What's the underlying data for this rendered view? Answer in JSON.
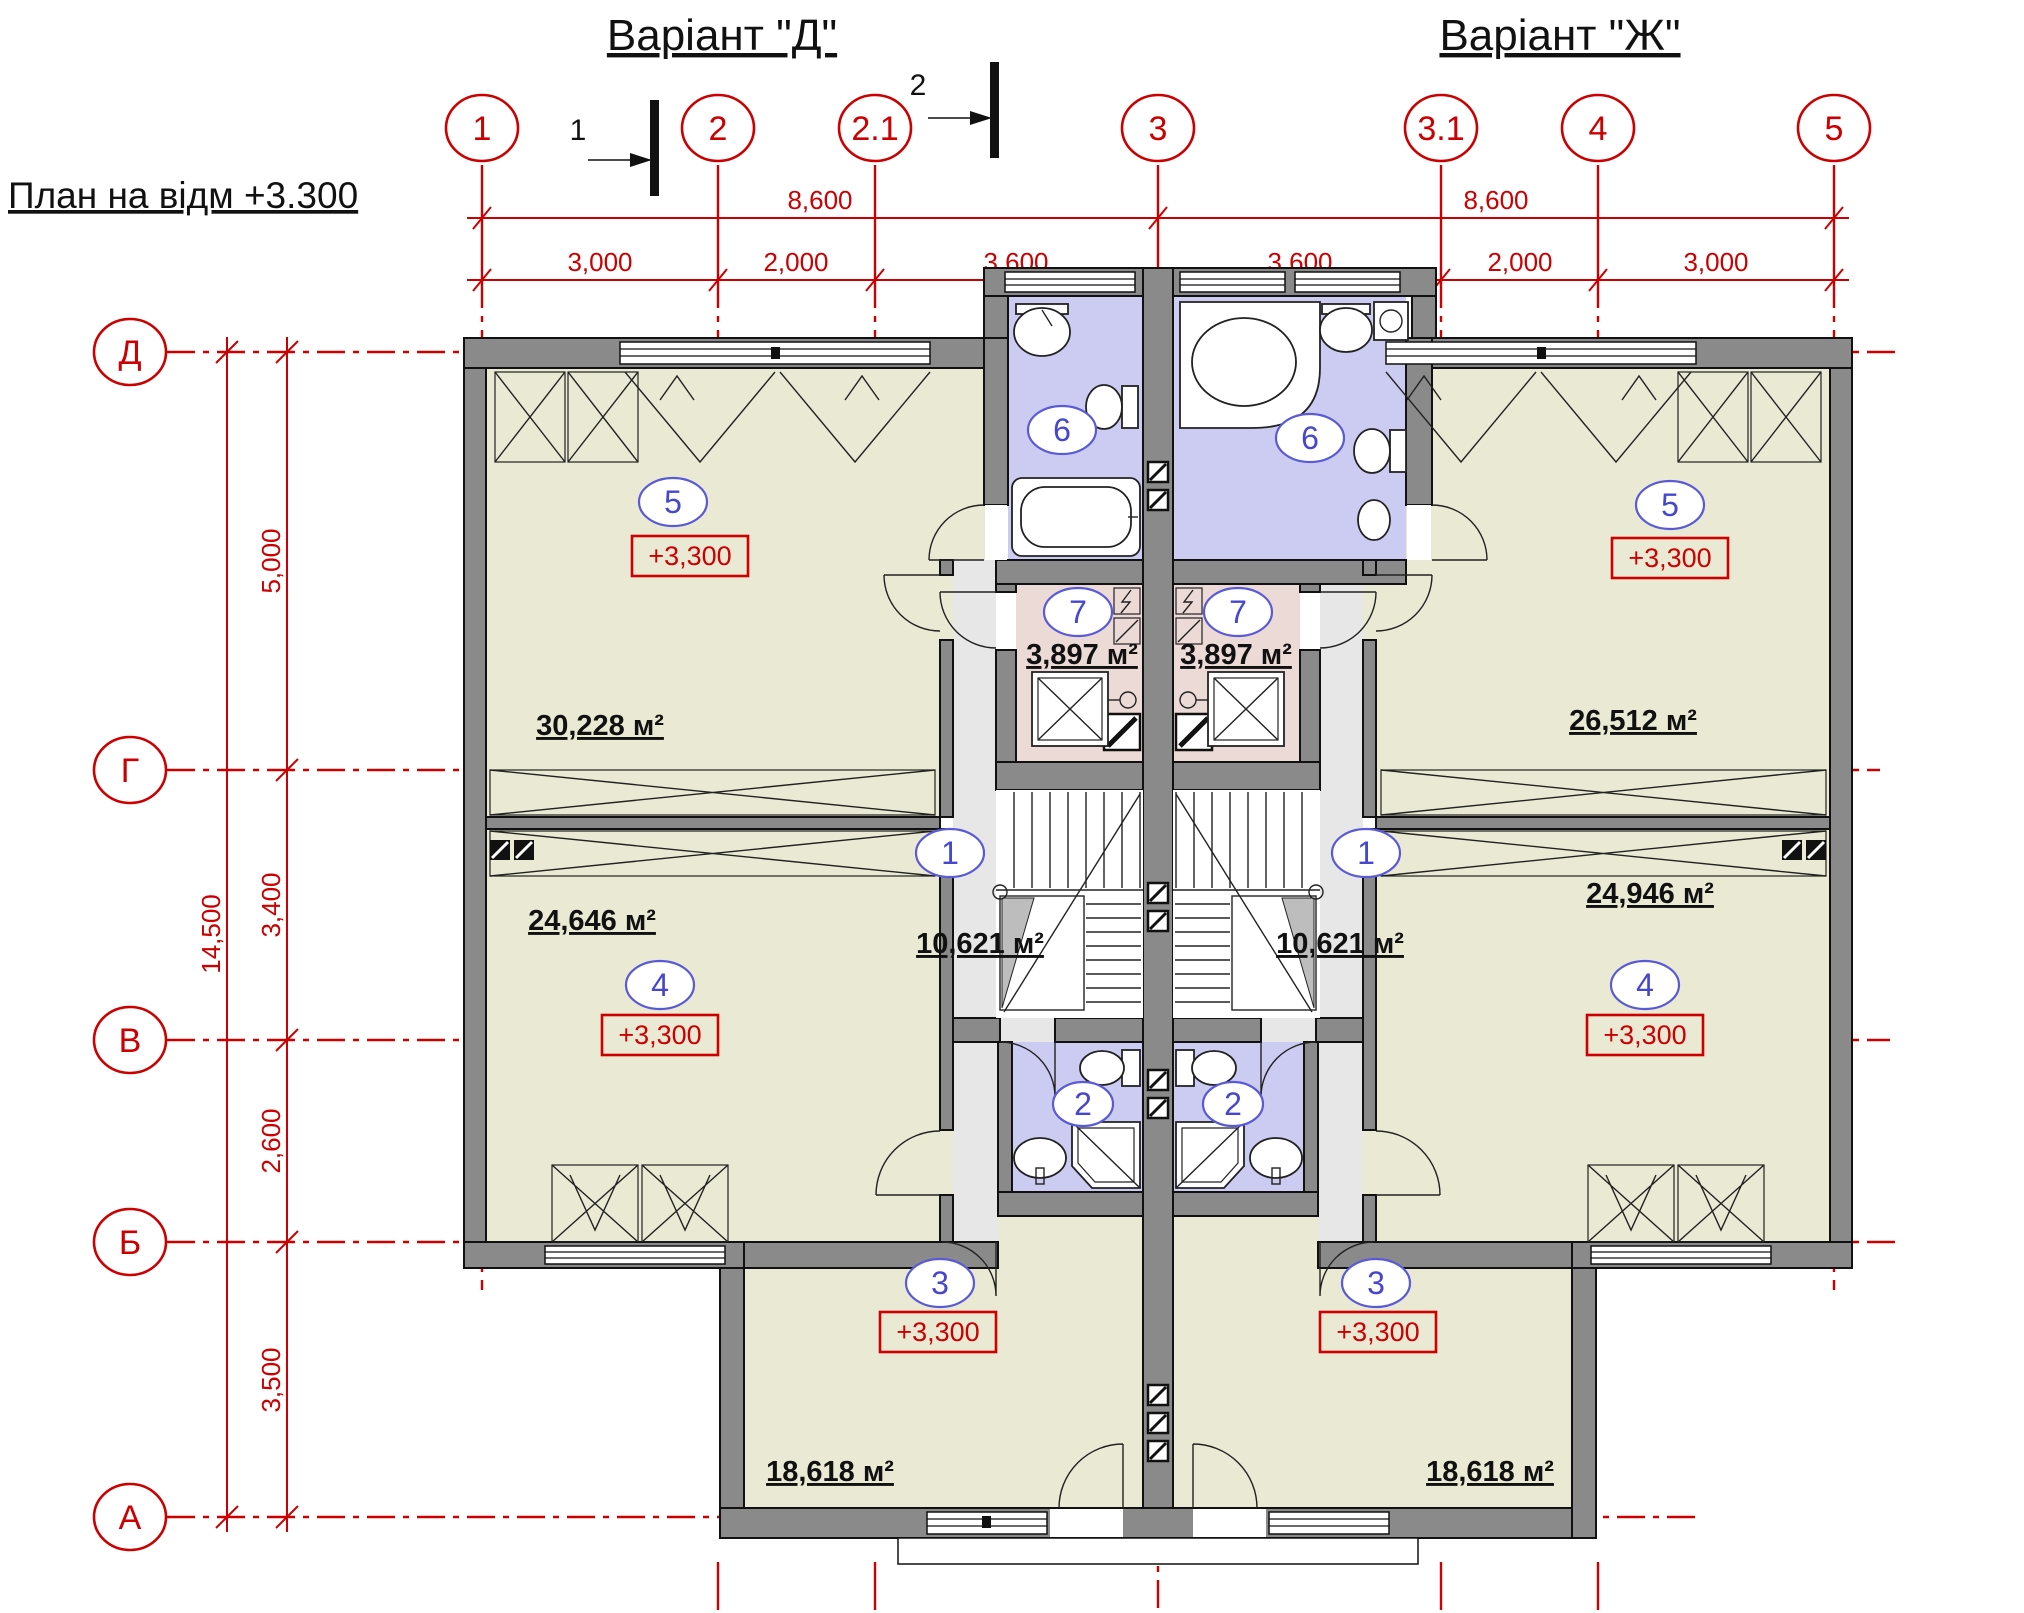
{
  "title": "План на відм +3.300",
  "variants": {
    "left": "Варіант \"Д\"",
    "right": "Варіант \"Ж\""
  },
  "sections": {
    "s1": "1",
    "s2": "2"
  },
  "grid": {
    "top": [
      "1",
      "2",
      "2.1",
      "3",
      "3.1",
      "4",
      "5"
    ],
    "left": [
      "Д",
      "Г",
      "В",
      "Б",
      "А"
    ]
  },
  "dims": {
    "span_left": "8,600",
    "span_right": "8,600",
    "segments": [
      "3,000",
      "2,000",
      "3,600",
      "3,600",
      "2,000",
      "3,000"
    ],
    "total": "14,500",
    "heights": [
      "5,000",
      "3,400",
      "2,600",
      "3,500"
    ]
  },
  "rooms": {
    "left": {
      "r5": {
        "n": "5",
        "e": "+3,300",
        "a": "30,228 м²"
      },
      "r6": {
        "n": "6"
      },
      "r7": {
        "n": "7",
        "a": "3,897 м²"
      },
      "r1": {
        "n": "1",
        "a": "10,621 м²"
      },
      "r4": {
        "n": "4",
        "e": "+3,300",
        "a": "24,646 м²"
      },
      "r2": {
        "n": "2"
      },
      "r3": {
        "n": "3",
        "e": "+3,300",
        "a": "18,618 м²"
      }
    },
    "right": {
      "r5": {
        "n": "5",
        "e": "+3,300",
        "a": "26,512 м²"
      },
      "r6": {
        "n": "6"
      },
      "r7": {
        "n": "7",
        "a": "3,897 м²"
      },
      "r1": {
        "n": "1",
        "a": "10,621 м²"
      },
      "r4": {
        "n": "4",
        "e": "+3,300",
        "a": "24,946 м²"
      },
      "r2": {
        "n": "2"
      },
      "r3": {
        "n": "3",
        "e": "+3,300",
        "a": "18,618 м²"
      }
    }
  },
  "colors": {
    "axis_red": "#cc0000",
    "wall_grey": "#8a8a8a",
    "room_beige": "#e9e9d4",
    "room_lavender": "#ccccf2",
    "room_pink": "#ecdad6",
    "hall_grey": "#e7e7e7",
    "label_blue": "#4646cf"
  }
}
